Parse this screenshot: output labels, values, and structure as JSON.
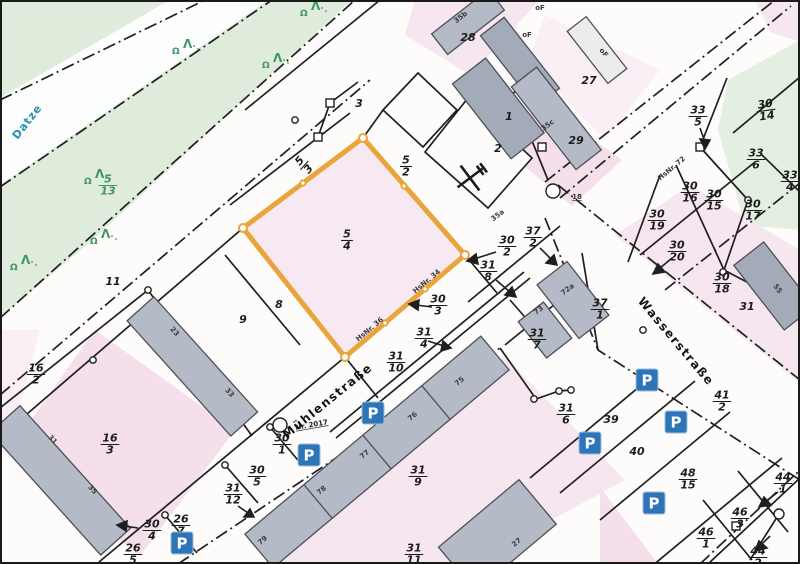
{
  "map": {
    "type": "cadastral-parcel-map",
    "highlighted_parcel": {
      "num": "5",
      "den": "4"
    },
    "colors": {
      "highlight_orange": "#e9a53c",
      "parcel_pink": "#f6e6ef",
      "parcel_pink_deep": "#f4dfeb",
      "area_green": "#dfecdc",
      "building_gray": "#b5bbc6",
      "building_dark": "#a4abb8",
      "building_stroke": "#4c4f57",
      "line_black": "#1f1f1f",
      "parking_blue": "#2e74b8",
      "water_text": "#2e8fae",
      "vegetation_text": "#3f9565"
    },
    "water_label": {
      "text": "Datze",
      "x": 30,
      "y": 124,
      "rot": -52
    },
    "street_labels": [
      {
        "text": "Mühlenstraße",
        "x": 330,
        "y": 404,
        "rot": -39
      },
      {
        "text": "Wasserstraße",
        "x": 673,
        "y": 344,
        "rot": 50
      }
    ],
    "street_sub_labels": [
      {
        "text": "Nr. 2017",
        "x": 312,
        "y": 427,
        "rot": -10
      }
    ],
    "fraction_labels": [
      {
        "num": "5",
        "den": "4",
        "x": 347,
        "y": 240,
        "rot": 0
      },
      {
        "num": "5",
        "den": "3",
        "x": 304,
        "y": 165,
        "rot": -48
      },
      {
        "num": "5",
        "den": "2",
        "x": 406,
        "y": 166,
        "rot": 0
      },
      {
        "num": "33",
        "den": "5",
        "x": 698,
        "y": 116,
        "rot": 0
      },
      {
        "num": "30",
        "den": "14",
        "x": 766,
        "y": 110,
        "rot": -8
      },
      {
        "num": "33",
        "den": "6",
        "x": 756,
        "y": 159,
        "rot": 0
      },
      {
        "num": "33",
        "den": "4",
        "x": 790,
        "y": 181,
        "rot": 0
      },
      {
        "num": "30",
        "den": "16",
        "x": 690,
        "y": 192,
        "rot": 0
      },
      {
        "num": "30",
        "den": "15",
        "x": 714,
        "y": 200,
        "rot": 0
      },
      {
        "num": "30",
        "den": "17",
        "x": 753,
        "y": 210,
        "rot": 0
      },
      {
        "num": "30",
        "den": "19",
        "x": 657,
        "y": 220,
        "rot": 0
      },
      {
        "num": "30",
        "den": "20",
        "x": 677,
        "y": 251,
        "rot": 0
      },
      {
        "num": "30",
        "den": "18",
        "x": 722,
        "y": 283,
        "rot": 0
      },
      {
        "num": "30",
        "den": "2",
        "x": 507,
        "y": 246,
        "rot": 0
      },
      {
        "num": "37",
        "den": "2",
        "x": 533,
        "y": 237,
        "rot": 0
      },
      {
        "num": "31",
        "den": "8",
        "x": 488,
        "y": 271,
        "rot": 0
      },
      {
        "num": "30",
        "den": "3",
        "x": 438,
        "y": 305,
        "rot": 0
      },
      {
        "num": "31",
        "den": "4",
        "x": 424,
        "y": 338,
        "rot": 0
      },
      {
        "num": "31",
        "den": "10",
        "x": 396,
        "y": 362,
        "rot": 0
      },
      {
        "num": "31",
        "den": "7",
        "x": 537,
        "y": 339,
        "rot": 0
      },
      {
        "num": "37",
        "den": "1",
        "x": 600,
        "y": 309,
        "rot": 0
      },
      {
        "num": "41",
        "den": "2",
        "x": 722,
        "y": 401,
        "rot": 0
      },
      {
        "num": "31",
        "den": "6",
        "x": 566,
        "y": 414,
        "rot": 0
      },
      {
        "num": "48",
        "den": "15",
        "x": 688,
        "y": 479,
        "rot": 0
      },
      {
        "num": "46",
        "den": "1",
        "x": 706,
        "y": 538,
        "rot": 0
      },
      {
        "num": "46",
        "den": "3",
        "x": 740,
        "y": 518,
        "rot": 0
      },
      {
        "num": "44",
        "den": "1",
        "x": 783,
        "y": 483,
        "rot": 0
      },
      {
        "num": "44",
        "den": "2",
        "x": 758,
        "y": 557,
        "rot": 0
      },
      {
        "num": "16",
        "den": "2",
        "x": 36,
        "y": 374,
        "rot": 0
      },
      {
        "num": "16",
        "den": "3",
        "x": 110,
        "y": 444,
        "rot": 0
      },
      {
        "num": "30",
        "den": "4",
        "x": 152,
        "y": 530,
        "rot": 0
      },
      {
        "num": "26",
        "den": "7",
        "x": 181,
        "y": 525,
        "rot": 0
      },
      {
        "num": "26",
        "den": "5",
        "x": 133,
        "y": 554,
        "rot": 0
      },
      {
        "num": "31",
        "den": "12",
        "x": 233,
        "y": 494,
        "rot": 0
      },
      {
        "num": "30",
        "den": "5",
        "x": 257,
        "y": 476,
        "rot": 0
      },
      {
        "num": "30",
        "den": "1",
        "x": 282,
        "y": 444,
        "rot": 0
      },
      {
        "num": "31",
        "den": "9",
        "x": 418,
        "y": 476,
        "rot": 0
      },
      {
        "num": "31",
        "den": "11",
        "x": 414,
        "y": 554,
        "rot": 0
      }
    ],
    "green_fraction_labels": [
      {
        "num": "5",
        "den": "13",
        "x": 108,
        "y": 185,
        "rot": 0
      }
    ],
    "plain_labels": [
      {
        "text": "3",
        "x": 359,
        "y": 107
      },
      {
        "text": "8",
        "x": 279,
        "y": 308
      },
      {
        "text": "9",
        "x": 243,
        "y": 323
      },
      {
        "text": "11",
        "x": 113,
        "y": 285
      },
      {
        "text": "2",
        "x": 498,
        "y": 152
      },
      {
        "text": "1",
        "x": 509,
        "y": 120
      },
      {
        "text": "28",
        "x": 468,
        "y": 41
      },
      {
        "text": "27",
        "x": 589,
        "y": 84
      },
      {
        "text": "29",
        "x": 576,
        "y": 144
      },
      {
        "text": "31",
        "x": 747,
        "y": 310
      },
      {
        "text": "39",
        "x": 611,
        "y": 423
      },
      {
        "text": "40",
        "x": 637,
        "y": 455
      }
    ],
    "house_number_labels": [
      {
        "text": "35b",
        "x": 462,
        "y": 19,
        "rot": -38
      },
      {
        "text": "oF",
        "x": 540,
        "y": 10,
        "rot": 0
      },
      {
        "text": "oF",
        "x": 527,
        "y": 37,
        "rot": 0
      },
      {
        "text": "oF",
        "x": 602,
        "y": 54,
        "rot": 52
      },
      {
        "text": "35c",
        "x": 549,
        "y": 127,
        "rot": -38
      },
      {
        "text": "35a",
        "x": 499,
        "y": 217,
        "rot": -38
      },
      {
        "text": "18",
        "x": 577,
        "y": 199,
        "rot": 0,
        "underline": true
      },
      {
        "text": "HsNr. 72",
        "x": 673,
        "y": 170,
        "rot": -40
      },
      {
        "text": "HsNr. 34",
        "x": 428,
        "y": 283,
        "rot": -40
      },
      {
        "text": "HsNr. 36",
        "x": 371,
        "y": 331,
        "rot": -40
      },
      {
        "text": "72a",
        "x": 569,
        "y": 291,
        "rot": -38
      },
      {
        "text": "73",
        "x": 540,
        "y": 312,
        "rot": -38
      },
      {
        "text": "75",
        "x": 461,
        "y": 383,
        "rot": -40
      },
      {
        "text": "76",
        "x": 414,
        "y": 418,
        "rot": -40
      },
      {
        "text": "77",
        "x": 366,
        "y": 456,
        "rot": -40
      },
      {
        "text": "78",
        "x": 323,
        "y": 492,
        "rot": -40
      },
      {
        "text": "79",
        "x": 264,
        "y": 542,
        "rot": -40
      },
      {
        "text": "23",
        "x": 173,
        "y": 333,
        "rot": 48
      },
      {
        "text": "33",
        "x": 228,
        "y": 394,
        "rot": 48
      },
      {
        "text": "31",
        "x": 51,
        "y": 441,
        "rot": 48
      },
      {
        "text": "35",
        "x": 91,
        "y": 491,
        "rot": 48
      },
      {
        "text": "55",
        "x": 776,
        "y": 290,
        "rot": 52
      },
      {
        "text": "27",
        "x": 518,
        "y": 544,
        "rot": -40
      }
    ],
    "parking_icons": {
      "letter": "P",
      "positions": [
        {
          "x": 373,
          "y": 413
        },
        {
          "x": 309,
          "y": 455
        },
        {
          "x": 182,
          "y": 543
        },
        {
          "x": 647,
          "y": 380
        },
        {
          "x": 676,
          "y": 422
        },
        {
          "x": 590,
          "y": 443
        },
        {
          "x": 654,
          "y": 503
        }
      ]
    },
    "tree_symbols": [
      {
        "x": 300,
        "y": 16
      },
      {
        "x": 172,
        "y": 54
      },
      {
        "x": 262,
        "y": 68
      },
      {
        "x": 84,
        "y": 184
      },
      {
        "x": 90,
        "y": 244
      },
      {
        "x": 10,
        "y": 270
      }
    ],
    "landmark_symbol": {
      "name": "crossed-tools",
      "x": 470,
      "y": 178
    }
  }
}
